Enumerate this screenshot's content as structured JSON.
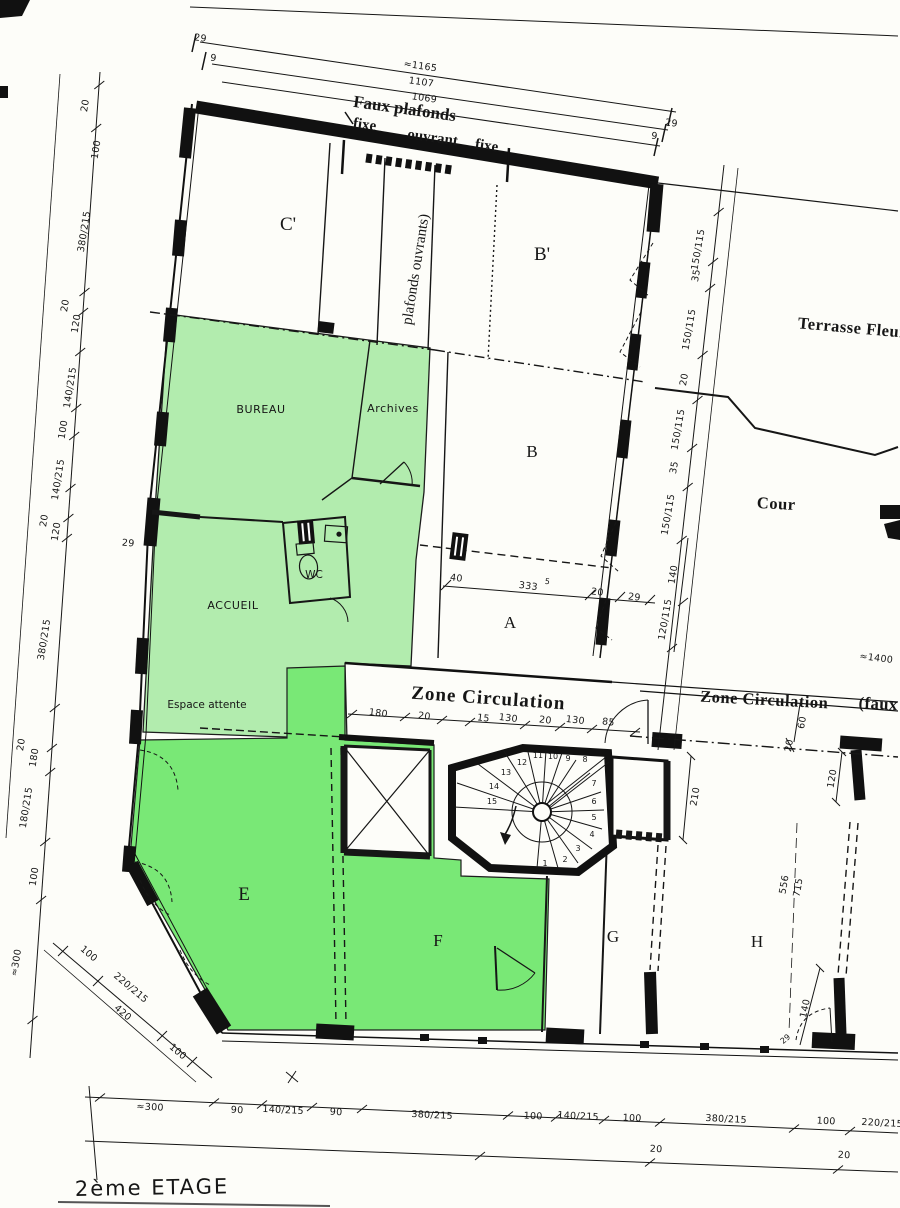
{
  "title": "2ème ETAGE",
  "colors": {
    "light_green": "#b2ecae",
    "bright_green": "#79e876",
    "ink": "#161616",
    "paper": "#fdfdf9"
  },
  "rooms": {
    "c1": "C'",
    "b1": "B'",
    "b": "B",
    "a": "A",
    "e": "E",
    "f": "F",
    "g": "G",
    "h": "H"
  },
  "spaces": {
    "bureau": "BUREAU",
    "archives": "Archives",
    "accueil": "ACCUEIL",
    "wc": "WC",
    "espace": "Espace attente",
    "terrasse": "Terrasse Fleur",
    "cour": "Cour",
    "zone1": "Zone Circulation",
    "zone2": "Zone Circulation",
    "zone2_note": "(faux"
  },
  "ceiling": {
    "l1": "Faux plafonds",
    "fixe1": "fixe",
    "ouvrant": "ouvrant",
    "fixe2": "fixe",
    "vertical": "plafonds ouvrants)"
  },
  "stairs": [
    "1",
    "2",
    "3",
    "4",
    "5",
    "6",
    "7",
    "8",
    "9",
    "10",
    "11",
    "12",
    "13",
    "14",
    "15"
  ],
  "dims": {
    "top": [
      "≈1165",
      "1107",
      "1069"
    ],
    "top_left": [
      "29",
      "9"
    ],
    "top_right": [
      "29",
      "9"
    ],
    "left": [
      "20",
      "100",
      "380/215",
      "20",
      "120",
      "140/215",
      "100",
      "140/215",
      "20",
      "120",
      "380/215",
      "20",
      "180",
      "180/215",
      "100",
      "≈300"
    ],
    "wall29": "29",
    "lower_left": [
      "100",
      "220/215",
      "420",
      "100"
    ],
    "right": [
      "150/115",
      "35",
      "150/115",
      "20",
      "150/115",
      "35",
      "150/115"
    ],
    "right_lower": [
      "140",
      "120/115"
    ],
    "room_a": [
      "40",
      "333",
      "5",
      "20",
      "29"
    ],
    "zone1": [
      "180",
      "20",
      "15",
      "130",
      "20",
      "130",
      "85"
    ],
    "zone2": [
      "≈1400",
      "60",
      "20"
    ],
    "stair_side": [
      "210",
      "120"
    ],
    "h_col": [
      "556",
      "715"
    ],
    "bottom_right_v": [
      "140",
      "29"
    ],
    "bottom1": [
      "≈300",
      "90",
      "140/215",
      "90",
      "380/215",
      "100",
      "140/215",
      "100",
      "380/215",
      "100",
      "220/215"
    ],
    "bottom2": [
      "20",
      "20"
    ]
  }
}
